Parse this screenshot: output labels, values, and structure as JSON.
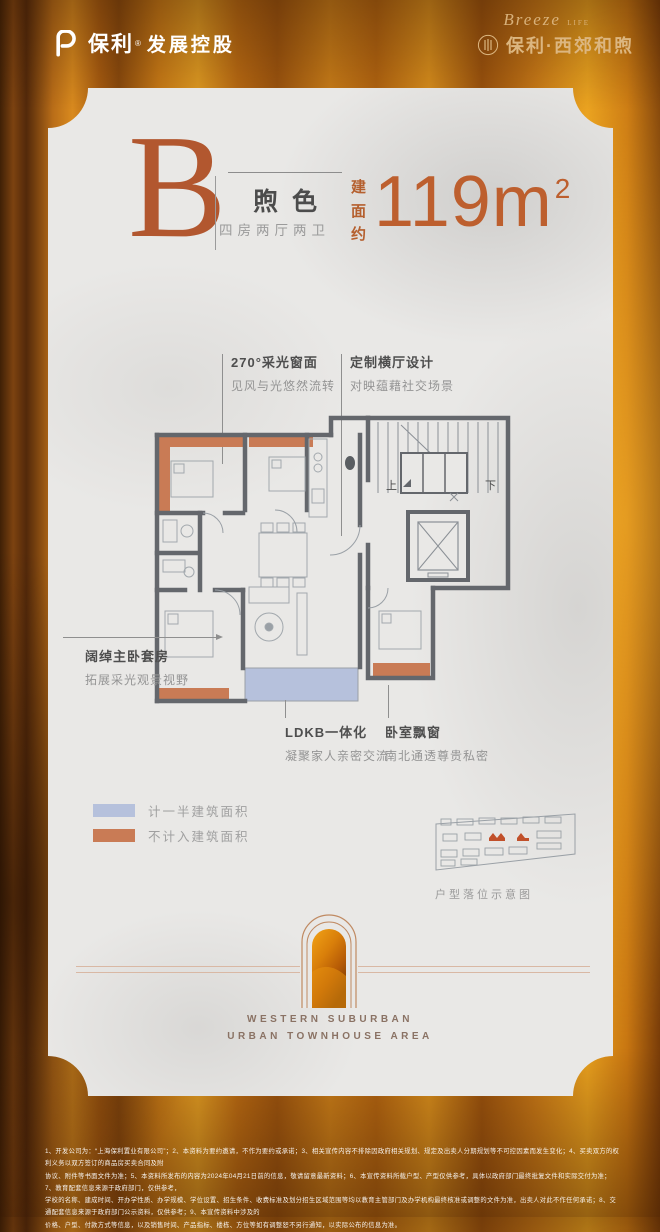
{
  "header": {
    "brand_left": {
      "name": "保利",
      "reg": "®",
      "suffix": "发展控股"
    },
    "brand_right": {
      "script": "Breeze",
      "script_sub": "LIFE",
      "name": "保利·西郊和煦"
    }
  },
  "title": {
    "letter": "B",
    "series": "煦色",
    "layout": "四房两厅两卫",
    "area_prefix": "建面约",
    "area_number": "119m",
    "area_sup": "2"
  },
  "annotations": {
    "window270": {
      "title": "270°采光窗面",
      "desc": "见风与光悠然流转"
    },
    "hall": {
      "title": "定制横厅设计",
      "desc": "对映蕴藉社交场景"
    },
    "master": {
      "title": "阔绰主卧套房",
      "desc": "拓展采光观景视野"
    },
    "ldkb": {
      "title": "LDKB一体化",
      "desc": "凝聚家人亲密交流"
    },
    "bay": {
      "title": "卧室飘窗",
      "desc": "南北通透尊贵私密"
    }
  },
  "plan": {
    "up": "上",
    "down": "下"
  },
  "legend": {
    "half": {
      "color": "#b6c1dc",
      "label": "计一半建筑面积"
    },
    "excluded": {
      "color": "#c97b55",
      "label": "不计入建筑面积"
    }
  },
  "site_map": {
    "caption": "户型落位示意图"
  },
  "arch": {
    "line1": "WESTERN SUBURBAN",
    "line2": "URBAN TOWNHOUSE AREA"
  },
  "disclaimer": {
    "lines": [
      "1、开发公司为：“上海保利置业有限公司”；2、本资料为要约邀请，不作为要约或承诺；3、相关宣传内容不排除因政府相关规划、规定及出卖人分期规划等不可控因素而发生变化；4、买卖双方的权利义务以双方签订的商品房买卖合同及附",
      "协议、附件等书面文件为准；5、本资料所发布的内容为2024年04月21日前的信息，敬请留意最新资料；6、本宣传资料所载户型、产型仅供参考，具体以政府部门最终批复文件和实际交付为准；7、教育配套信息来源于政府部门，仅供参考，",
      "学校的名称、建成时间、开办学性质、办学规模、学位设置、招生条件、收费标准及划分招生区域范围等均以教育主管部门及办学机构最终核准或调整的文件为准，出卖人对此不作任何承诺；8、交通配套信息来源于政府部门公示资料，仅供参考；9、本宣传资料中涉及的",
      "价格、户型、付款方式等信息，以及销售时间、产品指标、楼栋、方位等如有调整恕不另行通知，以实际公布的信息为准。"
    ]
  },
  "colors": {
    "accent": "#b9602f",
    "wall": "#64676c",
    "card": "#e9e8e6",
    "half_area": "#b6c1dc",
    "excluded_area": "#c97b55"
  }
}
